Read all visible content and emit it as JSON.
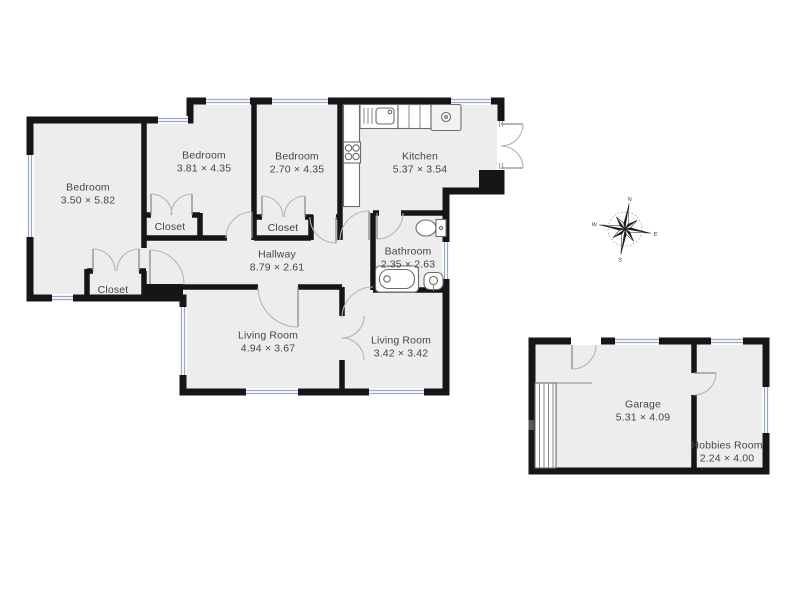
{
  "floor_plan": {
    "rooms": [
      {
        "name": "Bedroom",
        "dims": "3.50 × 5.82",
        "cx": 88,
        "cy": 194
      },
      {
        "name": "Bedroom",
        "dims": "3.81 × 4.35",
        "cx": 204,
        "cy": 162
      },
      {
        "name": "Bedroom",
        "dims": "2.70 × 4.35",
        "cx": 297,
        "cy": 163
      },
      {
        "name": "Kitchen",
        "dims": "5.37 × 3.54",
        "cx": 420,
        "cy": 163
      },
      {
        "name": "Closet",
        "dims": "",
        "cx": 170,
        "cy": 227
      },
      {
        "name": "Closet",
        "dims": "",
        "cx": 283,
        "cy": 228
      },
      {
        "name": "Closet",
        "dims": "",
        "cx": 113,
        "cy": 290
      },
      {
        "name": "Hallway",
        "dims": "8.79 × 2.61",
        "cx": 277,
        "cy": 261
      },
      {
        "name": "Bathroom",
        "dims": "2.35 × 2.63",
        "cx": 408,
        "cy": 258
      },
      {
        "name": "Living Room",
        "dims": "4.94 × 3.67",
        "cx": 268,
        "cy": 342
      },
      {
        "name": "Living Room",
        "dims": "3.42 × 3.42",
        "cx": 401,
        "cy": 347
      },
      {
        "name": "Garage",
        "dims": "5.31 × 4.09",
        "cx": 643,
        "cy": 411
      },
      {
        "name": "Hobbies Room",
        "dims": "2.24 × 4.00",
        "cx": 727,
        "cy": 452
      }
    ],
    "compass": {
      "n": "N",
      "e": "E",
      "s": "S",
      "w": "W"
    },
    "colors": {
      "wall": "#161616",
      "room_fill": "#ededed",
      "window_glass": "#9aa6c6",
      "door_arc": "#b5b5b5",
      "door_leaf": "#8c8c8c",
      "fixture": "#6b6b6b",
      "label_text": "#41464b",
      "background": "#ffffff"
    }
  }
}
